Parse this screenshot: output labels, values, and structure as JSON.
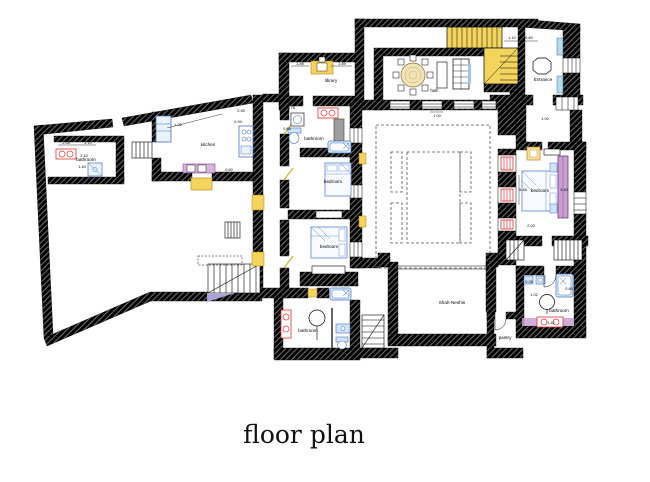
{
  "title": "floor plan",
  "rooms": {
    "bathroom_left": "bathroom",
    "kitchen": "kitchen",
    "library": "library",
    "hall": "hall",
    "entrance": "Entrance",
    "bathroom_mid": "bathroom",
    "bedroom_mid1": "bedroom",
    "bedroom_mid2": "bedroom",
    "bedroom_right": "bedroom",
    "bathroom_bottom": "bathroom",
    "bathroom_right": "bathroom",
    "pantry": "pantry",
    "shah_neshin": "Shah-Neshin"
  },
  "dims": [
    "2.28",
    "1.10",
    "2.10",
    "1.40",
    "1.02",
    "0.95",
    "0.94",
    "0.60",
    "1.89",
    "1.89",
    "1.74",
    "0.78",
    "0.66",
    "1.00",
    "1.10",
    "0.80",
    "0.70",
    "1.00",
    "0.44",
    "5.48",
    "3.40",
    "1.00",
    "2.00",
    "0.26",
    "0.80",
    "1.02",
    "1.42",
    "0.44",
    "1.00"
  ],
  "colors": {
    "wall": "#000000",
    "stair_yellow": "#f3d45c",
    "door_yellow": "#f3d45c",
    "fixture_blue": "#4a72c4",
    "pane_blue": "#b7d9ee",
    "furniture_purple": "#c9a0d0",
    "radiator_red": "#e03131",
    "table_wood": "#f1e3bb",
    "ramp_lavender": "#a9a3d6"
  }
}
